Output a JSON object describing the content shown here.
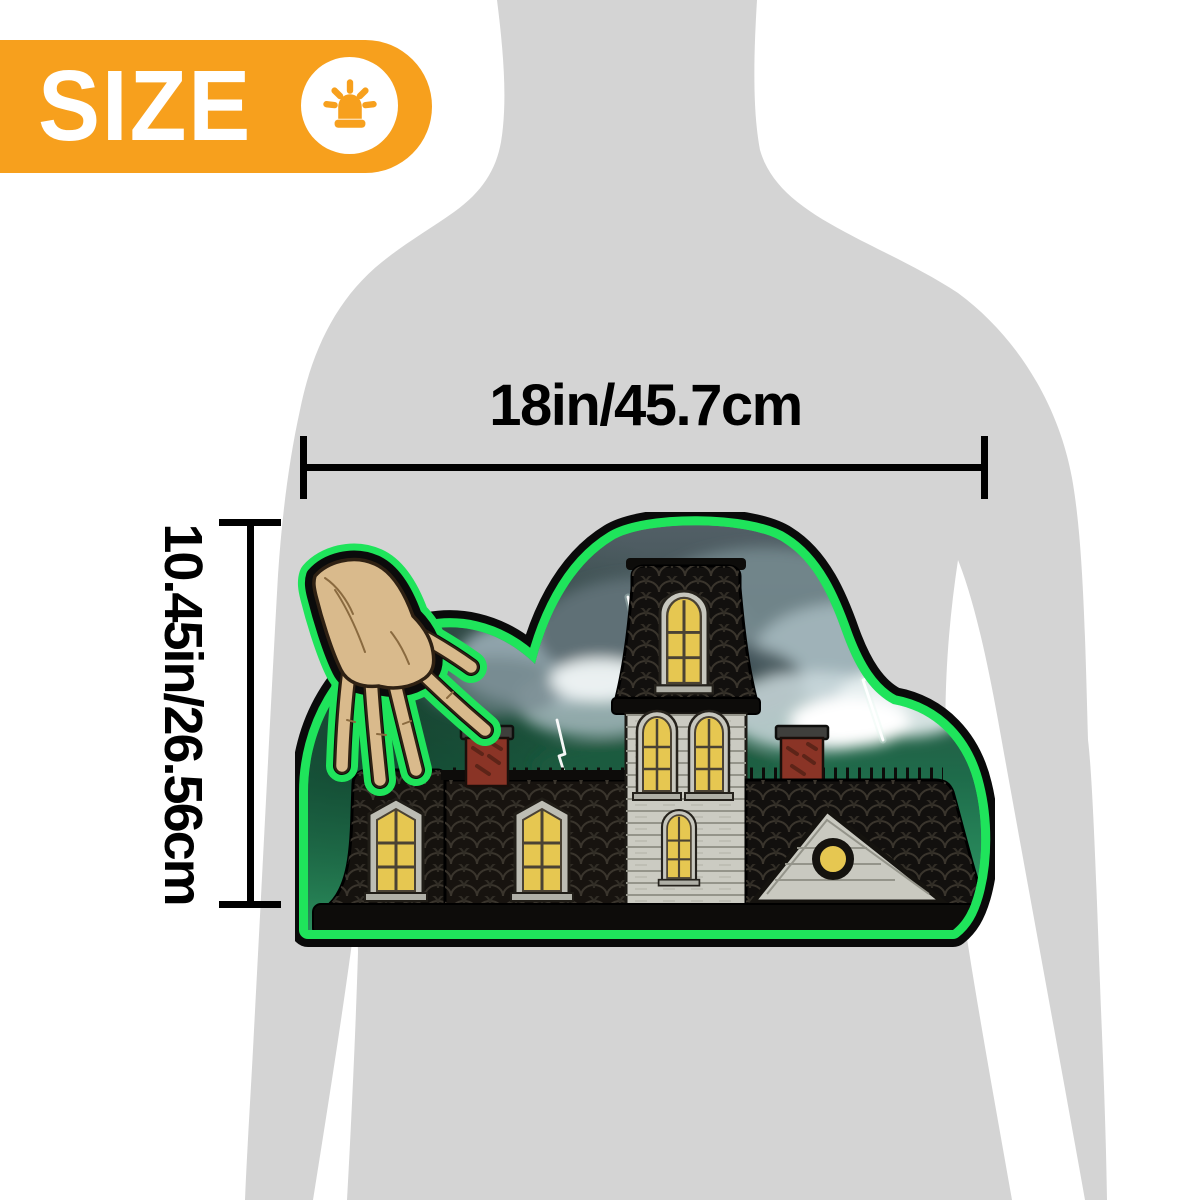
{
  "size_badge": {
    "label": "SIZE",
    "icon": "siren-alert-icon"
  },
  "dimension_width": {
    "label": "18in/45.7cm"
  },
  "dimension_height": {
    "label": "10.45in/26.56cm"
  },
  "product": {
    "name": "haunted-house-halloween-plaque-with-thing-hand",
    "scene": "storm-clouds-and-lightning-over-haunted-mansion"
  },
  "colors": {
    "badge_orange": "#F7A01D",
    "glow_green": "#1FE45B",
    "outline_black": "#0A0A0A",
    "silhouette_gray": "#D4D4D4",
    "window_yellow": "#E6C751",
    "chimney_red": "#8A3426",
    "sky_teal": "#265A45",
    "ground_green": "#32A169",
    "hand_skin": "#D9BA8C"
  }
}
